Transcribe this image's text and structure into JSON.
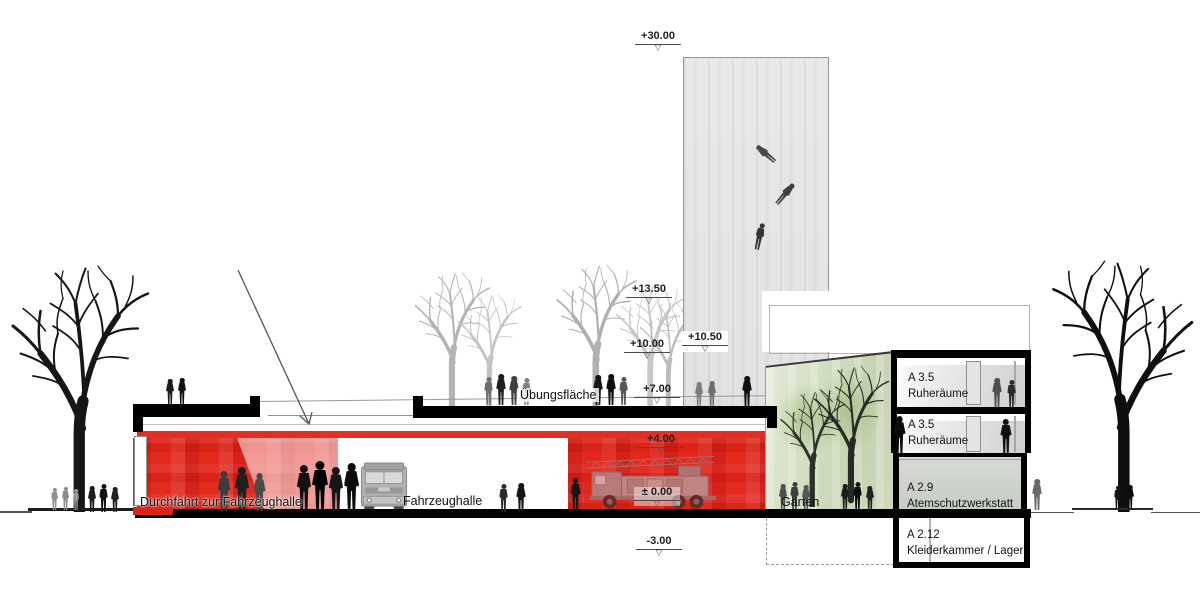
{
  "drawing": {
    "type": "architectural-section",
    "levels": [
      {
        "id": "l3000",
        "label": "+30.00"
      },
      {
        "id": "l1350",
        "label": "+13.50"
      },
      {
        "id": "l1050",
        "label": "+10.50"
      },
      {
        "id": "l1000",
        "label": "+10.00"
      },
      {
        "id": "l700",
        "label": "+7.00"
      },
      {
        "id": "l400",
        "label": "+4.00"
      },
      {
        "id": "l000",
        "label": "± 0.00"
      },
      {
        "id": "lm300",
        "label": "-3.00"
      }
    ],
    "areas": {
      "uebungsflaeche": "Übungsfläche",
      "durchfahrt": "Durchfahrt zur Fahrzeughalle",
      "fahrzeughalle": "Fahrzeughalle",
      "garten": "Garten"
    },
    "rooms": [
      {
        "code": "A 3.5",
        "name": "Ruheräume"
      },
      {
        "code": "A 3.5",
        "name": "Ruheräume"
      },
      {
        "code": "A 2.9",
        "name": "Atemschutzwerkstatt"
      },
      {
        "code": "A 2.12",
        "name": "Kleiderkammer / Lager"
      }
    ],
    "icons": {
      "level_symbol": "▽"
    },
    "colors": {
      "red": "#de231a",
      "pale_red": "#f3b7b2",
      "garden_green": "#cfdabf",
      "tower_gray": "#e6e6e6",
      "ink": "#111111"
    }
  }
}
